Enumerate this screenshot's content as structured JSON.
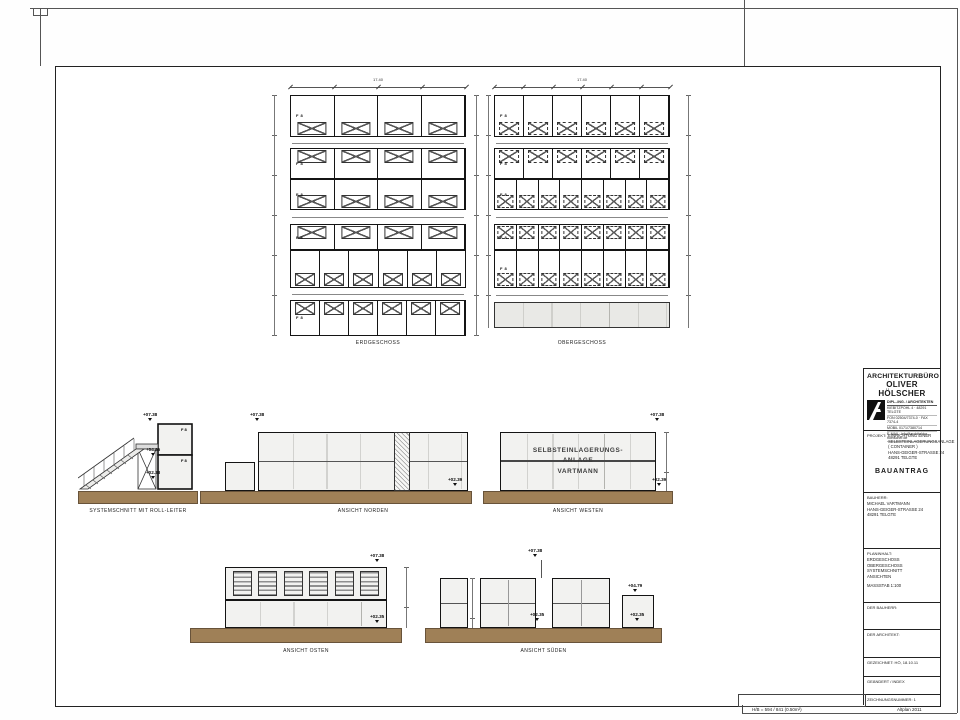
{
  "colors": {
    "ground": "#9f8057",
    "line": "#141414",
    "fill": "#f2f2f0"
  },
  "plans": {
    "unit_label": "F 8",
    "erdgeschoss": {
      "label": "ERDGESCHOSS",
      "overall_dim": "17.40",
      "segment_dim": "5.80",
      "rows": [
        {
          "cells": 4,
          "doors": "bottom",
          "h": 42,
          "tag": true
        },
        {
          "aisle": 11
        },
        {
          "cells": 4,
          "doors": "top",
          "h": 31,
          "tag": true
        },
        {
          "cells": 4,
          "doors": "bottom",
          "h": 31,
          "tag": true
        },
        {
          "aisle": 14
        },
        {
          "cells": 4,
          "doors": "top",
          "h": 26,
          "tag": true
        },
        {
          "cells": 6,
          "doors": "bottom",
          "h": 38
        },
        {
          "aisle": 12
        },
        {
          "cells": 6,
          "doors": "top",
          "h": 36,
          "tag": true
        }
      ]
    },
    "obergeschoss": {
      "label": "OBERGESCHOSS",
      "overall_dim": "17.40",
      "segment_dim": "2.90",
      "rows": [
        {
          "cells": 6,
          "doors": "bottom",
          "h": 42,
          "tag": true
        },
        {
          "aisle": 11
        },
        {
          "cells": 6,
          "doors": "top",
          "h": 31,
          "tag": true
        },
        {
          "cells": 8,
          "doors": "bottom",
          "h": 31,
          "tag": true
        },
        {
          "aisle": 14
        },
        {
          "cells": 8,
          "doors": "top",
          "h": 26,
          "tag": true
        },
        {
          "cells": 8,
          "doors": "bottom",
          "h": 38,
          "tag": true
        },
        {
          "aisle": 14
        },
        {
          "empty": true,
          "h": 26
        }
      ]
    }
  },
  "elevations": {
    "schnitt": {
      "label": "SYSTEMSCHNITT MIT ROLL-LEITER",
      "level_top": "+07.38",
      "level_mid": "+04.35",
      "level_ground": "+02.38"
    },
    "nord": {
      "label": "ANSICHT NORDEN",
      "level_top": "+07.38",
      "level_ground": "+02.39"
    },
    "west": {
      "label": "ANSICHT WESTEN",
      "level_top": "+07.38",
      "level_ground": "+02.39",
      "sign_lines": [
        "SELBSTEINLAGERUNGS-",
        "ANLAGE",
        "VARTMANN"
      ]
    },
    "ost": {
      "label": "ANSICHT OSTEN",
      "level_top": "+07.38",
      "level_ground": "+02.35",
      "louver_count": 6
    },
    "sued": {
      "label": "ANSICHT SÜDEN",
      "level_top": "+07.38",
      "level_ground": "+02.35",
      "small_top": "+04.79",
      "small_ground": "+02.35"
    }
  },
  "titleblock": {
    "firm_line1": "ARCHITEKTURBÜRO",
    "firm_line2": "OLIVER HÖLSCHER",
    "firm_sub": "DIPL.-ING. / ARCHITEKTEN",
    "firm_address": "KIEBITZPOHL 4 · 48291 TELGTE",
    "firm_contact1": "FON 02504/7374-0 · FAX 7374-4",
    "firm_contact2": "MOBIL 0171/7380714",
    "firm_contact3": "E-MAIL: info@architektur-hoelscher.de",
    "projekt_label": "PROJEKT:",
    "projekt_lines": [
      "EINRICHTUNG EINER",
      "SELBSTEINLAGERUNGSANLAGE",
      "( CONTAINER )",
      "HANS-GEIGER-STRASSE 24",
      "48291 TELGTE"
    ],
    "bauantrag": "BAUANTRAG",
    "bauherr_label": "BAUHERR:",
    "bauherr_lines": [
      "MICHAEL VARTMANN",
      "HANS-GEIGER-STRASSE 24",
      "48291 TELGTE"
    ],
    "planinhalt_label": "PLANINHALT:",
    "planinhalt_lines": [
      "ERDGESCHOSS",
      "OBERGESCHOSS",
      "SYSTEMSCHNITT",
      "ANSICHTEN"
    ],
    "massstab": "MASSSTAB 1:100",
    "der_bauherr": "DER BAUHERR:",
    "der_architekt": "DER ARCHITEKT:",
    "gezeichnet": "GEZEICHNET: HÖ, 18.10.11",
    "geaendert": "GEÄNDERT / INDEX",
    "zeichnungsnummer": "ZEICHNUNGSNUMMER: 1"
  },
  "footer": {
    "left": "H/B = 594 / 841 (0.50m²)",
    "right": "Altplan 2011"
  }
}
